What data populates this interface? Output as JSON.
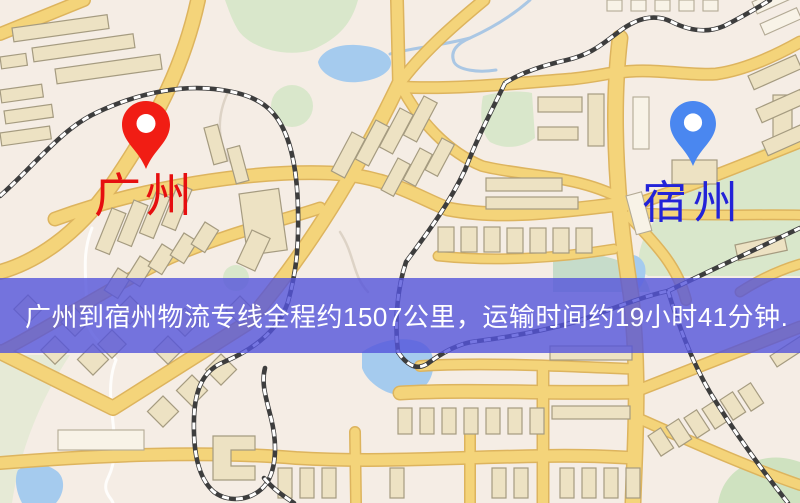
{
  "banner": {
    "text": "广州到宿州物流专线全程约1507公里，运输时间约19小时41分钟.",
    "background_color": "#5454db",
    "text_color": "#ffffff",
    "distance_km": "1507",
    "duration_hours": "19",
    "duration_minutes": "41"
  },
  "origin": {
    "label": "广州",
    "pin_icon": "map-pin",
    "pin_color": "#f11d14",
    "label_color": "#e60f0f"
  },
  "destination": {
    "label": "宿州",
    "pin_icon": "map-pin",
    "pin_color": "#4a87f0",
    "label_color": "#2323d8"
  },
  "map": {
    "background_color": "#f5ede5",
    "road_color": "#f4d47a",
    "railway_color": "#3d3d3d",
    "water_color": "#a5cbee",
    "green_color": "#d9e7cb",
    "building_color": "#ede2c3"
  }
}
